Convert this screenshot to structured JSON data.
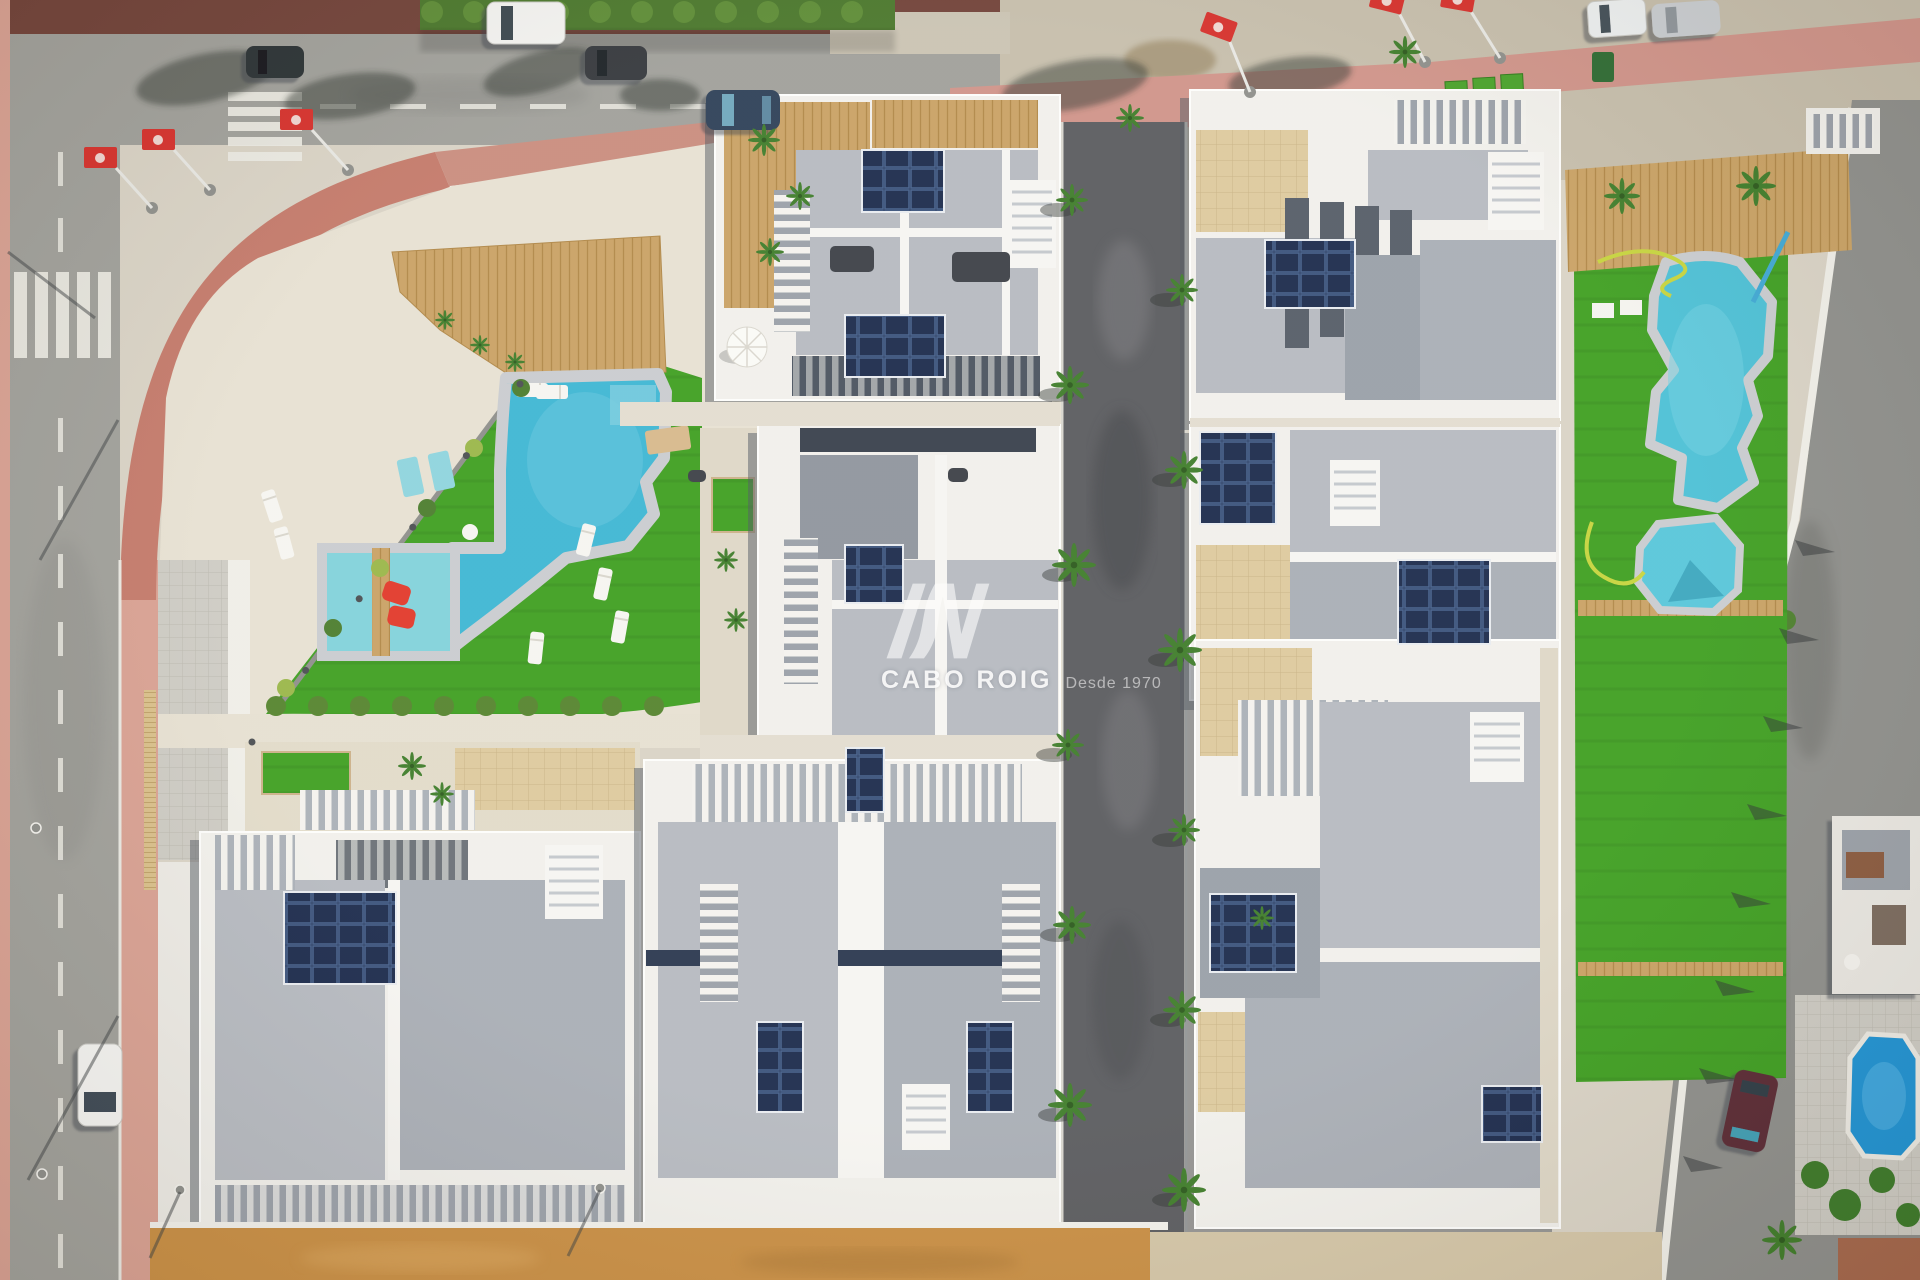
{
  "meta": {
    "type": "aerial-drone-photograph",
    "description": "Top-down aerial view of a new-build residential development of white villas with rooftop solar panels, two communal lawns with swimming pools, surrounding streets with parked cars, red promotional flags, and an unfinished central road; orange dirt ground along the bottom edge."
  },
  "watermark": {
    "logo": "AV",
    "brand": "CABO ROIG",
    "tagline": "Desde 1970"
  },
  "colors": {
    "lawn": "#3f9f22",
    "lawn2": "#37911d",
    "water": "#3eb6d4",
    "waterShallow": "#82d2db",
    "water2": "#4cc0d6",
    "water3": "#1f93d4",
    "coping": "#c9ccd0",
    "road": "#a0a09b",
    "roadDark": "#5b5c60",
    "roadRight": "#8e8f8c",
    "pink": "#d9a193",
    "terra": "#c47a6b",
    "maroon": "#714239",
    "gravel": "#e7e1d3",
    "base": "#d9d3c6",
    "sandTop": "#c6beac",
    "dirt": "#c98f45",
    "sand2": "#d4c6a8",
    "wood": "#c9a265",
    "tile": "#ddca9e",
    "white": "#f1f0ec",
    "roof": "#b6bac1",
    "roof2": "#a9aeb6",
    "roofDark": "#99a0a9",
    "solar": "#1c2b4d",
    "hedge": "#4a772c",
    "palm": "#3f7d2b",
    "flag": "#d6302c",
    "carblue": "#2e4058",
    "carmaroon": "#5a2c35",
    "navy": "#22365c"
  },
  "scene": {
    "pools": [
      {
        "name": "left-community-pool",
        "shape": "curved lagoon with shallow kids section and wooden step bridge"
      },
      {
        "name": "right-community-pool",
        "shape": "organic freeform pool with octagonal kids pool"
      },
      {
        "name": "neighbour-complex-pool",
        "shape": "small octagonal bright blue pool, bottom right"
      }
    ],
    "vehicles": [
      {
        "name": "white-van-top-left"
      },
      {
        "name": "black-car-top-left"
      },
      {
        "name": "dark-suv-top-left"
      },
      {
        "name": "blue-hatchback-top-center"
      },
      {
        "name": "white-van-top-right"
      },
      {
        "name": "silver-car-top-right"
      },
      {
        "name": "white-car-left-road"
      },
      {
        "name": "maroon-car-right-road"
      }
    ],
    "flags": {
      "count": 6,
      "color": "red with white emblem"
    },
    "buildings": "eight white villa blocks under construction with gray flat roofs, pergolas and navy solar panel arrays; one existing complex at bottom right",
    "landscape": [
      "artificial lawns",
      "white gravel plaza",
      "wooden sun decks",
      "sun loungers",
      "red pool floats",
      "garden hoses",
      "palm trees",
      "zebra crossings",
      "terracotta sidewalks",
      "orange dirt strip"
    ]
  }
}
